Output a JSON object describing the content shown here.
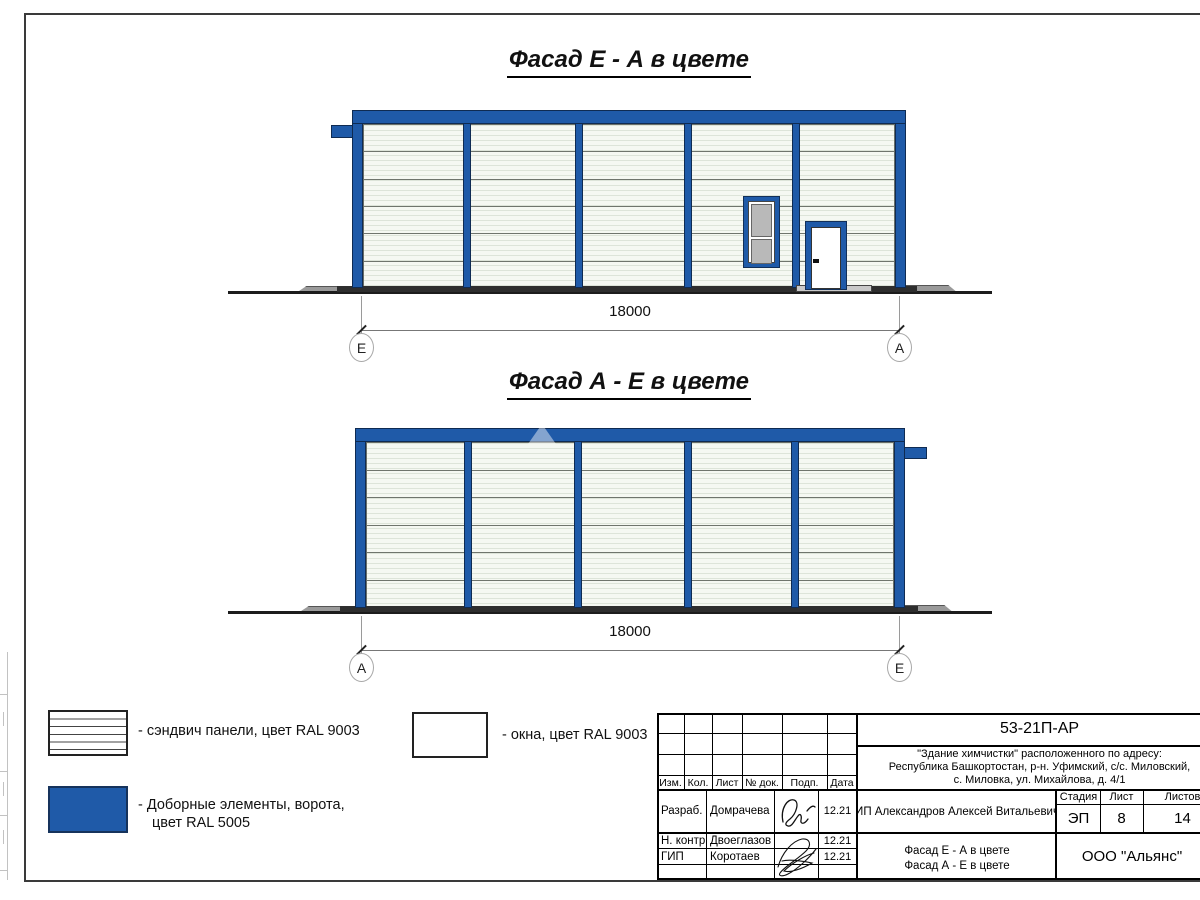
{
  "facades": [
    {
      "title": "Фасад Е - А в цвете",
      "dimension": "18000",
      "axis_left": "Е",
      "axis_right": "А"
    },
    {
      "title": "Фасад А - Е в цвете",
      "dimension": "18000",
      "axis_left": "А",
      "axis_right": "Е"
    }
  ],
  "legend": {
    "sandwich": "- сэндвич панели, цвет RAL 9003",
    "windows": "- окна, цвет RAL 9003",
    "extras_line1": "- Доборные элементы, ворота,",
    "extras_line2": "цвет RAL 5005"
  },
  "title_block": {
    "doc_number": "53-21П-АР",
    "project_line1": "\"Здание химчистки\" расположенного по адресу:",
    "project_line2": "Республика Башкортостан, р-н. Уфимский, с/с. Миловский,",
    "project_line3": "с. Миловка, ул. Михайлова, д. 4/1",
    "col_izm": "Изм.",
    "col_kol": "Кол.",
    "col_list": "Лист",
    "col_doc": "№ док.",
    "col_podp": "Подп.",
    "col_data": "Дата",
    "row1_role": "Разраб.",
    "row1_name": "Домрачева",
    "row1_date": "12.21",
    "row2_role": "Н. контр.",
    "row2_name": "Двоеглазов",
    "row2_date": "12.21",
    "row3_role": "ГИП",
    "row3_name": "Коротаев",
    "row3_date": "12.21",
    "client": "ИП Александров Алексей Витальевич",
    "stage_label": "Стадия",
    "sheet_label": "Лист",
    "sheets_label": "Листов",
    "stage": "ЭП",
    "sheet": "8",
    "sheets": "14",
    "sheet_title_line1": "Фасад Е - А в цвете",
    "sheet_title_line2": "Фасад А - Е в цвете",
    "company": "ООО \"Альянс\""
  },
  "colors": {
    "ral5005": "#1f5aa8",
    "ral9003": "#f5f8f2"
  }
}
